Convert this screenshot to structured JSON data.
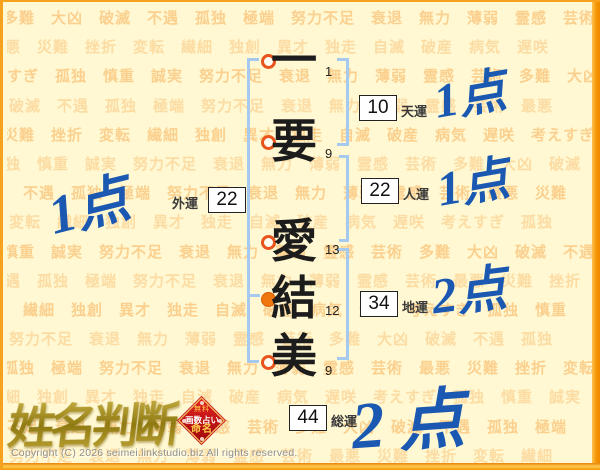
{
  "background": {
    "words": [
      "多難",
      "大凶",
      "破滅",
      "不遇",
      "孤独",
      "極端",
      "努力不足",
      "衰退",
      "無力",
      "薄弱",
      "霊感",
      "芸術",
      "最悪",
      "災難",
      "挫折",
      "変転",
      "繊細",
      "独創",
      "異才",
      "独走",
      "自滅",
      "破産",
      "病気",
      "遅咲",
      "考えすぎ",
      "孤独",
      "慎重",
      "誠実",
      "努力不足",
      "衰退",
      "無力",
      "薄弱",
      "霊感",
      "芸術"
    ],
    "word_color": "#F8AC52",
    "background_color": "#FFF8D2"
  },
  "name_chart": {
    "characters": [
      {
        "char": "一",
        "strokes": 1,
        "marker": "open"
      },
      {
        "char": "要",
        "strokes": 9,
        "marker": "open"
      },
      {
        "char": "愛",
        "strokes": 13,
        "marker": "open"
      },
      {
        "char": "結",
        "strokes": 12,
        "marker": "filled"
      },
      {
        "char": "美",
        "strokes": 9,
        "marker": "open"
      }
    ],
    "fortunes": [
      {
        "label": "天運",
        "value": 10,
        "score": "1点"
      },
      {
        "label": "人運",
        "value": 22,
        "score": "1点"
      },
      {
        "label": "地運",
        "value": 34,
        "score": "2点"
      },
      {
        "label": "外運",
        "value": 22,
        "score": "1点"
      },
      {
        "label": "総運",
        "value": 44,
        "score": "2点"
      }
    ]
  },
  "logo": {
    "text": "姓名判断"
  },
  "badge": {
    "lines": [
      "無料",
      "画数占い",
      "命名"
    ]
  },
  "footer": {
    "copyright": "Copyright (C) 2026 seimei.linkstudio.biz All rights reserved."
  },
  "colors": {
    "score_blue": "#1A58B2",
    "bracket_blue": "#A6C9EF",
    "marker_orange": "#F0760F",
    "marker_ring": "#E8541C",
    "border_orange": "#F6A21F",
    "badge_red": "#C60F10",
    "logo_gold": "#B89B2A"
  }
}
